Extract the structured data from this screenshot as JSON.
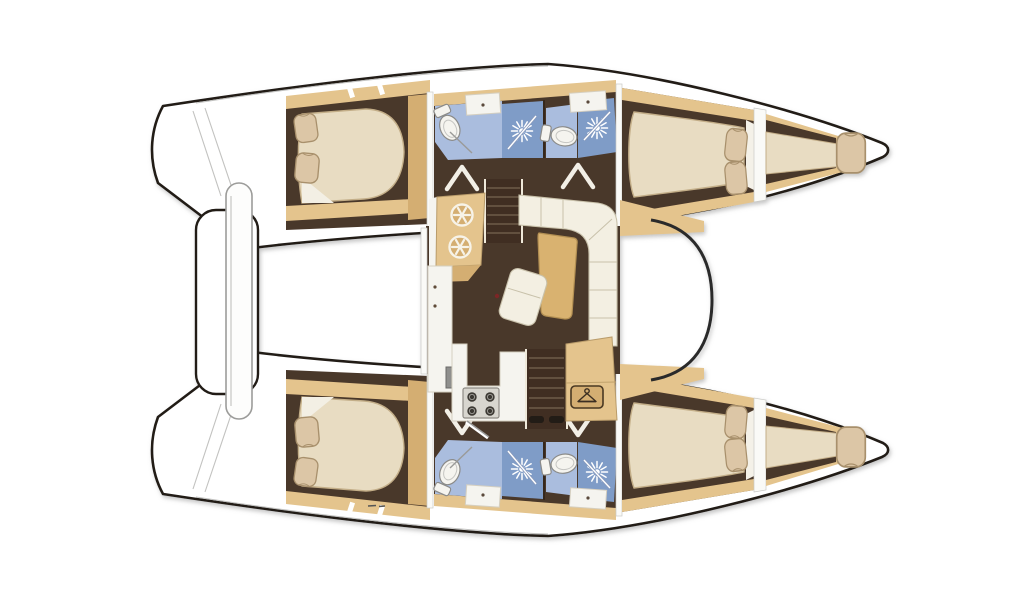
{
  "page": {
    "background": "#ffffff"
  },
  "diagram": {
    "kind": "catamaran-interior-floor-plan-top-view",
    "orientation": {
      "bow": "right",
      "stern": "left"
    },
    "visible_text": [],
    "hulls": [
      {
        "name": "port-hull-top",
        "aft_cabin": {
          "type": "double-berth",
          "pillows": 2
        },
        "bathrooms": [
          {
            "fixtures": [
              "toilet",
              "washbasin",
              "shower"
            ]
          },
          {
            "fixtures": [
              "toilet",
              "washbasin",
              "shower"
            ]
          }
        ],
        "forward_cabin": {
          "type": "double-berth",
          "pillows": 2
        },
        "forepeak": {
          "type": "single-berth",
          "pillows": 1
        }
      },
      {
        "name": "starboard-hull-bottom",
        "aft_cabin": {
          "type": "double-berth",
          "pillows": 2
        },
        "bathrooms": [
          {
            "fixtures": [
              "toilet",
              "washbasin",
              "shower"
            ]
          },
          {
            "fixtures": [
              "toilet",
              "washbasin",
              "shower"
            ]
          }
        ],
        "forward_cabin": {
          "type": "double-berth",
          "pillows": 2
        },
        "forepeak": {
          "type": "single-berth",
          "pillows": 1
        }
      }
    ],
    "saloon": {
      "features": [
        "twin-round-galley-sinks",
        "companionway-steps-port",
        "l-shaped-sofa",
        "dining-table",
        "lounge-chair",
        "galley-counter",
        "four-burner-stove",
        "companionway-steps-starboard",
        "hanging-locker",
        "curved-forward-windshield"
      ]
    },
    "aft_deck": {
      "features": [
        "transom-platform",
        "aft-bench"
      ]
    },
    "icons": {
      "shower": "sunburst-rays-icon",
      "hanging_locker": "coat-hanger-icon",
      "galley_sink": "spoked-circle-icon",
      "stove_burner": "dark-circle-icon"
    },
    "counts": {
      "cabins": 4,
      "bathrooms": 4,
      "showers": 4,
      "toilets": 4,
      "washbasins": 4,
      "forepeak_berths": 2
    },
    "colors": {
      "outline": "#211d19",
      "hull_white": "#ffffff",
      "floor": "#4a372a",
      "floor_dark": "#3f2e20",
      "wood": "#e4c48d",
      "wood_dark": "#d4ae72",
      "table_wood": "#d9b26f",
      "mattress": "#e8dcc2",
      "mattress_edge": "#c3ae88",
      "pillow": "#dcc6a6",
      "pillow_edge": "#a8906c",
      "sofa": "#f3efe2",
      "sofa_seam": "#c8c1aa",
      "bath_floor": "#aabdde",
      "shower_floor": "#7f9cc7",
      "fixture_white": "#f5f4ef",
      "appliance_gray": "#8f8f8d",
      "stove_panel": "#d8d6cf",
      "burner_dark": "#3b3833",
      "tread": "#6e5b49"
    }
  }
}
